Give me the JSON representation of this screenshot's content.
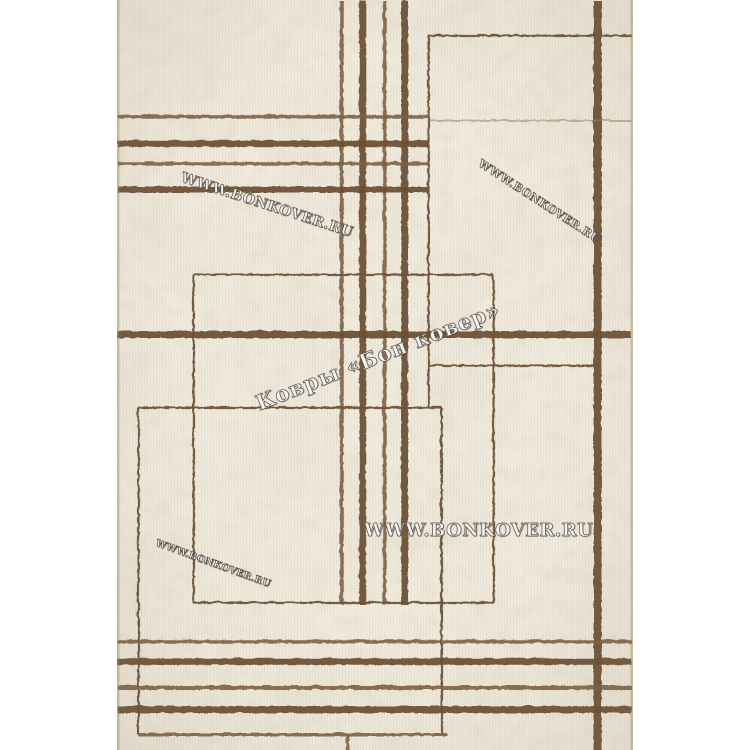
{
  "meta": {
    "description": "Product photograph of a cream marble-textured rug with brown geometric crossing lines and shop watermarks",
    "canvas": {
      "width": 750,
      "height": 750,
      "background": "#ffffff"
    }
  },
  "rug": {
    "left": 117,
    "top": 0,
    "width": 516,
    "height": 750,
    "base_color": "#f1ebde",
    "vein_color_rgb": "0.845 0.795 0.700",
    "speckle_color_rgb": "0.800 0.745 0.630",
    "rib_color": "rgba(118,102,76,0.055)",
    "edge_color": "rgba(140,122,92,0.38)"
  },
  "palette": {
    "thick": {
      "color": "#6a4f35",
      "opacity": 0.93
    },
    "medium": {
      "color": "#7d6044",
      "opacity": 0.9
    },
    "thin": {
      "color": "#6e5339",
      "opacity": 0.95
    },
    "faint": {
      "color": "#9d8463",
      "opacity": 0.55
    }
  },
  "lines": {
    "vertical": [
      {
        "x": 341,
        "y1": 0,
        "y2": 604,
        "w": 3.5,
        "c": "medium"
      },
      {
        "x": 362,
        "y1": 0,
        "y2": 604,
        "w": 6.5,
        "c": "thick"
      },
      {
        "x": 384,
        "y1": 0,
        "y2": 604,
        "w": 3.5,
        "c": "medium"
      },
      {
        "x": 404,
        "y1": 0,
        "y2": 604,
        "w": 7,
        "c": "thick"
      },
      {
        "x": 597,
        "y1": 0,
        "y2": 750,
        "w": 8,
        "c": "thick"
      },
      {
        "x": 428,
        "y1": 35,
        "y2": 407,
        "w": 2.2,
        "c": "thin"
      },
      {
        "x": 441,
        "y1": 407,
        "y2": 734,
        "w": 2.2,
        "c": "thin"
      },
      {
        "x": 193,
        "y1": 274,
        "y2": 602,
        "w": 2.2,
        "c": "thin"
      },
      {
        "x": 493,
        "y1": 274,
        "y2": 602,
        "w": 2.2,
        "c": "thin"
      },
      {
        "x": 138,
        "y1": 407,
        "y2": 734,
        "w": 2.2,
        "c": "thin"
      },
      {
        "x": 347,
        "y1": 734,
        "y2": 750,
        "w": 3,
        "c": "medium"
      }
    ],
    "horizontal": [
      {
        "y": 35,
        "x1": 428,
        "x2": 631,
        "w": 2.2,
        "c": "thin"
      },
      {
        "y": 116,
        "x1": 117,
        "x2": 428,
        "w": 3.5,
        "c": "medium"
      },
      {
        "y": 120,
        "x1": 428,
        "x2": 631,
        "w": 2,
        "c": "faint"
      },
      {
        "y": 143,
        "x1": 117,
        "x2": 428,
        "w": 6.5,
        "c": "thick"
      },
      {
        "y": 163,
        "x1": 117,
        "x2": 428,
        "w": 3.5,
        "c": "medium"
      },
      {
        "y": 189,
        "x1": 117,
        "x2": 428,
        "w": 6,
        "c": "thick"
      },
      {
        "y": 274,
        "x1": 193,
        "x2": 493,
        "w": 2.2,
        "c": "thin"
      },
      {
        "y": 334,
        "x1": 117,
        "x2": 630,
        "w": 7,
        "c": "thick"
      },
      {
        "y": 365,
        "x1": 428,
        "x2": 597,
        "w": 2.2,
        "c": "thin"
      },
      {
        "y": 407,
        "x1": 138,
        "x2": 441,
        "w": 2.2,
        "c": "thin"
      },
      {
        "y": 602,
        "x1": 193,
        "x2": 493,
        "w": 2.2,
        "c": "thin"
      },
      {
        "y": 641,
        "x1": 117,
        "x2": 631,
        "w": 3.5,
        "c": "medium"
      },
      {
        "y": 661,
        "x1": 117,
        "x2": 631,
        "w": 6.5,
        "c": "thick"
      },
      {
        "y": 687,
        "x1": 117,
        "x2": 631,
        "w": 4,
        "c": "medium"
      },
      {
        "y": 709,
        "x1": 117,
        "x2": 631,
        "w": 7,
        "c": "thick"
      },
      {
        "y": 734,
        "x1": 138,
        "x2": 447,
        "w": 3,
        "c": "medium"
      }
    ]
  },
  "watermarks": [
    {
      "name": "watermark-top-left",
      "text": "WWW.BONKOVER.RU",
      "x": 184,
      "y": 170,
      "angle": 18,
      "size": 14,
      "spacing": 0.5,
      "weight": 600
    },
    {
      "name": "watermark-top-right",
      "text": "WWW.BONKOVER.RU",
      "x": 483,
      "y": 157,
      "angle": 33,
      "size": 11,
      "spacing": 0.5,
      "weight": 600
    },
    {
      "name": "watermark-center",
      "text": "Ковры «Бон ковер»",
      "x": 252,
      "y": 392,
      "angle": -21.5,
      "size": 21,
      "spacing": 1,
      "weight": 700
    },
    {
      "name": "watermark-large",
      "text": "WWW.BONKOVER.RU",
      "x": 364,
      "y": 520,
      "angle": 0,
      "size": 18,
      "spacing": 0.5,
      "weight": 700
    },
    {
      "name": "watermark-bottom-left",
      "text": "WWW.BONKOVER.RU",
      "x": 158,
      "y": 538,
      "angle": 20,
      "size": 9.5,
      "spacing": 0.3,
      "weight": 600
    }
  ]
}
